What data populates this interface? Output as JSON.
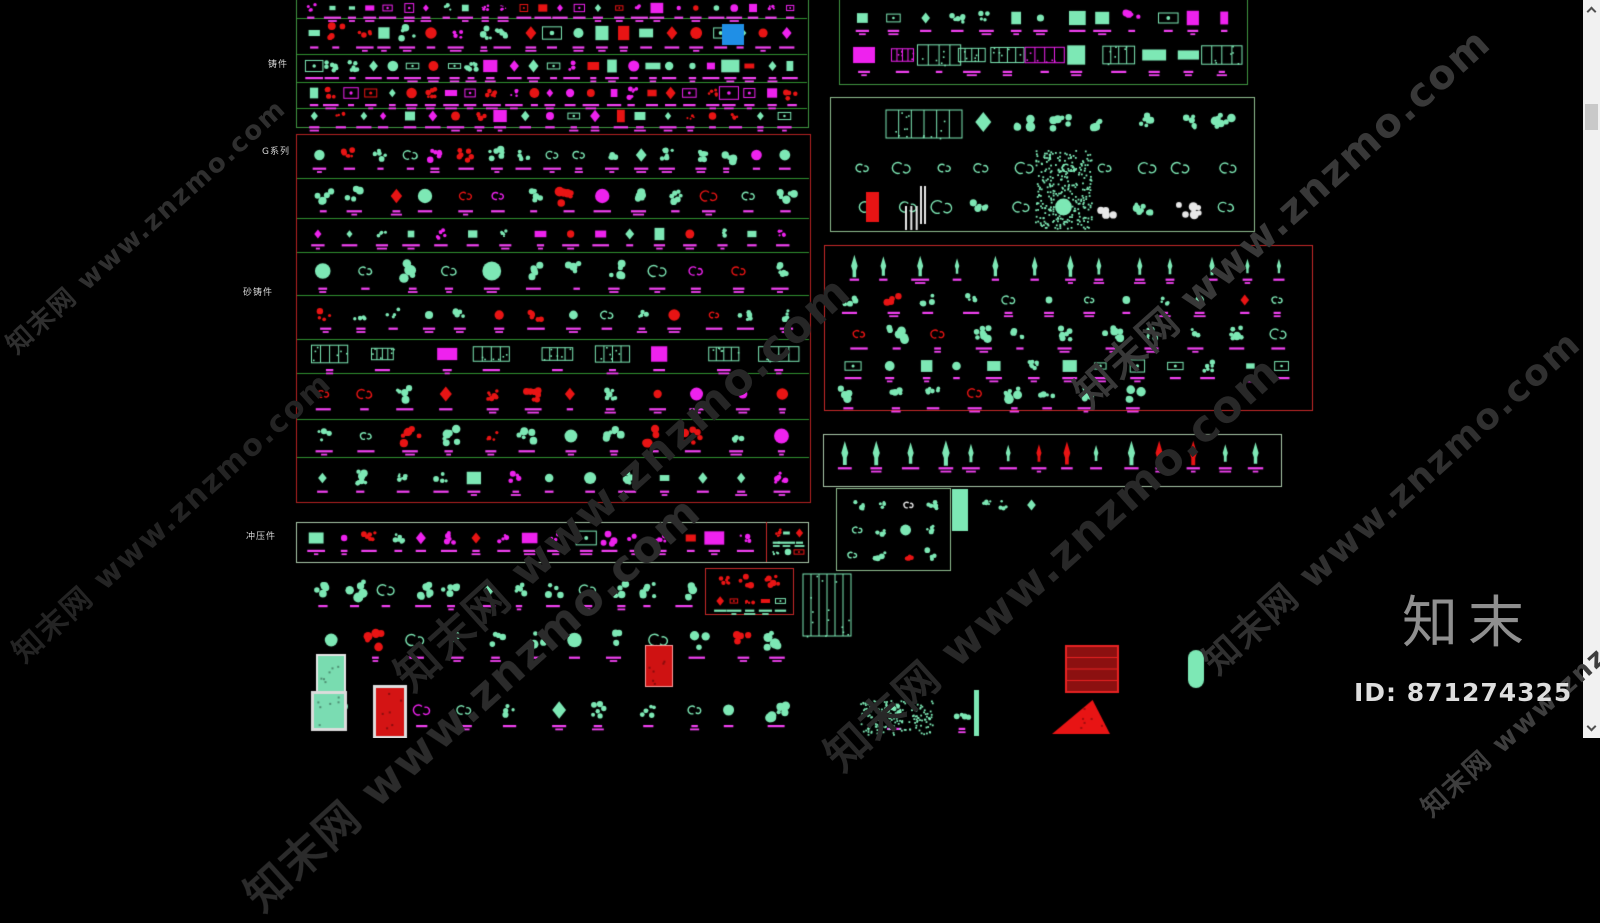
{
  "canvas": {
    "width": 1600,
    "height": 738,
    "bg": "#000000"
  },
  "palette": {
    "teal": "#7de8b5",
    "magenta": "#ee22ee",
    "magenta_label": "#f241f2",
    "red": "#e81414",
    "white": "#e8e8e8",
    "blue": "#1f8fe6",
    "green_line": "#2f8f2f",
    "green_box": "#3f9440",
    "pale_green_box": "#a9c7a9",
    "soft_green_box": "#8fbc8f",
    "red_box": "#c62828",
    "dark_red_box": "#b42222"
  },
  "category_labels": [
    {
      "text": "铸件",
      "x": 268,
      "y": 61
    },
    {
      "text": "G系列",
      "x": 262,
      "y": 148
    },
    {
      "text": "砂铸件",
      "x": 243,
      "y": 289
    },
    {
      "text": "冲压件",
      "x": 246,
      "y": 533
    }
  ],
  "watermark": {
    "text": "知末网 www.znzmo.com",
    "instances": [
      {
        "x": 145,
        "y": 225,
        "size": 26,
        "color": "#2f2f2f"
      },
      {
        "x": 170,
        "y": 515,
        "size": 30,
        "color": "#242424"
      },
      {
        "x": 620,
        "y": 480,
        "size": 44,
        "color": "#262626"
      },
      {
        "x": 470,
        "y": 700,
        "size": 44,
        "color": "#2b2b2b"
      },
      {
        "x": 1050,
        "y": 560,
        "size": 44,
        "color": "#282828"
      },
      {
        "x": 1280,
        "y": 215,
        "size": 40,
        "color": "#383838"
      },
      {
        "x": 1390,
        "y": 500,
        "size": 36,
        "color": "#303030"
      },
      {
        "x": 1560,
        "y": 688,
        "size": 26,
        "color": "#3e3e3e"
      }
    ]
  },
  "brand": {
    "logo_text": "知末",
    "id_text": "ID: 871274325"
  },
  "scrollbar": {
    "thumb_top": 104,
    "thumb_height": 26
  },
  "groups": [
    {
      "name": "cast-parts-group",
      "box": [
        296,
        -6,
        512,
        133
      ],
      "border": "#3f9440",
      "lines": [
        18,
        54,
        82,
        108
      ],
      "rows": [
        {
          "cy": 8,
          "x0": 303,
          "x1": 801,
          "count": 26,
          "size": 7,
          "style": "mixed",
          "colors": {
            "m": 6,
            "t": 2,
            "r": 1
          },
          "label": "m"
        },
        {
          "cy": 33,
          "x0": 303,
          "x1": 801,
          "count": 21,
          "size": 13,
          "style": "mixed",
          "colors": {
            "t": 4,
            "r": 3,
            "m": 3
          },
          "label": "m"
        },
        {
          "cy": 66,
          "x0": 303,
          "x1": 801,
          "count": 25,
          "size": 10,
          "style": "mixed",
          "colors": {
            "t": 5,
            "m": 3,
            "r": 1
          },
          "label": "m"
        },
        {
          "cy": 93,
          "x0": 303,
          "x1": 801,
          "count": 25,
          "size": 10,
          "style": "mixed",
          "colors": {
            "r": 4,
            "m": 4,
            "t": 2
          },
          "label": "m"
        },
        {
          "cy": 116,
          "x0": 303,
          "x1": 795,
          "count": 21,
          "size": 9,
          "style": "mixed",
          "colors": {
            "r": 3,
            "t": 4,
            "m": 2
          },
          "label": "m"
        }
      ]
    },
    {
      "name": "g-series-group",
      "box": [
        296,
        134,
        514,
        368
      ],
      "border": "#b42222",
      "lines": [
        178,
        218,
        252,
        295,
        339,
        373,
        419,
        457
      ],
      "rows": [
        {
          "cy": 155,
          "x0": 305,
          "x1": 800,
          "count": 17,
          "size": 12,
          "style": "ornament",
          "colors": {
            "t": 6,
            "r": 3,
            "m": 1
          },
          "label": "m"
        },
        {
          "cy": 196,
          "x0": 305,
          "x1": 800,
          "count": 14,
          "size": 14,
          "style": "ornament",
          "colors": {
            "t": 6,
            "r": 2,
            "m": 2
          },
          "label": "m"
        },
        {
          "cy": 234,
          "x0": 305,
          "x1": 800,
          "count": 16,
          "size": 9,
          "style": "mixed",
          "colors": {
            "t": 5,
            "m": 4,
            "r": 1
          },
          "label": "m"
        },
        {
          "cy": 271,
          "x0": 305,
          "x1": 800,
          "count": 12,
          "size": 17,
          "style": "ornament",
          "colors": {
            "t": 8,
            "r": 1,
            "m": 1
          },
          "label": "m"
        },
        {
          "cy": 315,
          "x0": 305,
          "x1": 800,
          "count": 14,
          "size": 12,
          "style": "ornament",
          "colors": {
            "t": 6,
            "r": 2,
            "m": 2
          },
          "label": "m"
        },
        {
          "cy": 354,
          "x0": 305,
          "x1": 800,
          "count": 9,
          "size": 15,
          "style": "panel",
          "colors": {
            "t": 9,
            "m": 1
          },
          "label": "m"
        },
        {
          "cy": 394,
          "x0": 305,
          "x1": 800,
          "count": 12,
          "size": 14,
          "style": "ornament",
          "colors": {
            "r": 5,
            "t": 4,
            "m": 1
          },
          "label": "m"
        },
        {
          "cy": 436,
          "x0": 305,
          "x1": 800,
          "count": 12,
          "size": 14,
          "style": "ornament",
          "colors": {
            "r": 3,
            "t": 6,
            "m": 1
          },
          "label": "m"
        },
        {
          "cy": 478,
          "x0": 305,
          "x1": 800,
          "count": 13,
          "size": 12,
          "style": "mixed",
          "colors": {
            "t": 7,
            "m": 2,
            "r": 1
          },
          "label": "m"
        }
      ]
    },
    {
      "name": "stamped-parts-strip",
      "box": [
        296,
        522,
        512,
        40
      ],
      "border": "#a9c7a9",
      "lines": [],
      "rows": [
        {
          "cy": 538,
          "x0": 304,
          "x1": 756,
          "count": 17,
          "size": 11,
          "style": "mixed",
          "colors": {
            "m": 6,
            "r": 3,
            "t": 2
          },
          "label": "m"
        },
        {
          "cy": 533,
          "x0": 770,
          "x1": 804,
          "count": 3,
          "size": 7,
          "style": "mixed",
          "colors": {
            "t": 6,
            "r": 4
          },
          "label": "t"
        },
        {
          "cy": 552,
          "x0": 770,
          "x1": 804,
          "count": 3,
          "size": 6,
          "style": "mixed",
          "colors": {
            "t": 5,
            "r": 5
          },
          "label": ""
        }
      ]
    },
    {
      "name": "red-detail-box",
      "box": [
        705,
        568,
        88,
        46
      ],
      "border": "#c62828",
      "lines": [],
      "rows": [
        {
          "cy": 581,
          "x0": 712,
          "x1": 786,
          "count": 3,
          "size": 11,
          "style": "ornament",
          "colors": {
            "r": 10
          },
          "label": ""
        },
        {
          "cy": 601,
          "x0": 712,
          "x1": 786,
          "count": 5,
          "size": 7,
          "style": "mixed",
          "colors": {
            "r": 6,
            "t": 4
          },
          "label": "t"
        }
      ]
    },
    {
      "name": "top-right-group",
      "box": [
        839,
        -6,
        408,
        90
      ],
      "border": "#3f9440",
      "lines": [],
      "rows": [
        {
          "cy": 18,
          "x0": 848,
          "x1": 1240,
          "count": 13,
          "size": 11,
          "style": "mixed",
          "colors": {
            "t": 6,
            "m": 3,
            "r": 1
          },
          "label": "m"
        },
        {
          "cy": 55,
          "x0": 848,
          "x1": 1240,
          "count": 11,
          "size": 16,
          "style": "panel",
          "colors": {
            "t": 7,
            "m": 3
          },
          "label": "m"
        }
      ]
    },
    {
      "name": "scrollwork-group",
      "box": [
        830,
        97,
        424,
        134
      ],
      "border": "#8fbc8f",
      "lines": [],
      "rows": [
        {
          "cy": 122,
          "x0": 960,
          "x1": 1245,
          "count": 7,
          "size": 16,
          "style": "ornament",
          "colors": {
            "t": 10
          },
          "label": ""
        },
        {
          "cy": 168,
          "x0": 845,
          "x1": 1245,
          "count": 10,
          "size": 15,
          "style": "scroll",
          "colors": {
            "t": 10
          },
          "label": ""
        },
        {
          "cy": 207,
          "x0": 845,
          "x1": 1245,
          "count": 10,
          "size": 17,
          "style": "ornament",
          "colors": {
            "t": 9,
            "w": 1
          },
          "label": ""
        }
      ]
    },
    {
      "name": "finials-red-group",
      "box": [
        824,
        245,
        488,
        165
      ],
      "border": "#c62828",
      "lines": [],
      "rows": [
        {
          "cy": 266,
          "x0": 833,
          "x1": 1300,
          "count": 13,
          "size": 12,
          "style": "finial",
          "colors": {
            "t": 10
          },
          "label": "m"
        },
        {
          "cy": 300,
          "x0": 833,
          "x1": 1300,
          "count": 12,
          "size": 11,
          "style": "ornament",
          "colors": {
            "t": 9,
            "r": 1
          },
          "label": "m"
        },
        {
          "cy": 334,
          "x0": 833,
          "x1": 1300,
          "count": 11,
          "size": 13,
          "style": "ornament",
          "colors": {
            "t": 9,
            "r": 1
          },
          "label": "m"
        },
        {
          "cy": 366,
          "x0": 833,
          "x1": 1300,
          "count": 13,
          "size": 10,
          "style": "mixed",
          "colors": {
            "t": 10
          },
          "label": "m"
        },
        {
          "cy": 393,
          "x0": 833,
          "x1": 1150,
          "count": 8,
          "size": 14,
          "style": "ornament",
          "colors": {
            "t": 9,
            "r": 1
          },
          "label": "m"
        }
      ]
    },
    {
      "name": "spear-tips-strip",
      "box": [
        823,
        434,
        458,
        52
      ],
      "border": "#a9c7a9",
      "lines": [],
      "rows": [
        {
          "cy": 453,
          "x0": 833,
          "x1": 1272,
          "count": 14,
          "size": 14,
          "style": "finial",
          "colors": {
            "t": 11,
            "r": 3
          },
          "label": "m"
        }
      ]
    },
    {
      "name": "misc-small-group",
      "box": [
        836,
        488,
        114,
        82
      ],
      "border": "#8fbc8f",
      "lines": [],
      "rows": [
        {
          "cy": 505,
          "x0": 843,
          "x1": 943,
          "count": 4,
          "size": 11,
          "style": "ornament",
          "colors": {
            "t": 8,
            "w": 2
          },
          "label": ""
        },
        {
          "cy": 530,
          "x0": 843,
          "x1": 943,
          "count": 4,
          "size": 12,
          "style": "ornament",
          "colors": {
            "t": 8,
            "r": 1,
            "w": 1
          },
          "label": ""
        },
        {
          "cy": 555,
          "x0": 843,
          "x1": 943,
          "count": 4,
          "size": 11,
          "style": "ornament",
          "colors": {
            "t": 9,
            "r": 1
          },
          "label": ""
        }
      ]
    }
  ],
  "loose_rows": [
    {
      "cy": 505,
      "x0": 975,
      "x1": 1040,
      "count": 3,
      "size": 10,
      "style": "ornament",
      "colors": {
        "t": 10
      },
      "label": ""
    },
    {
      "cy": 590,
      "x0": 305,
      "x1": 700,
      "count": 12,
      "size": 15,
      "style": "ornament",
      "colors": {
        "t": 9,
        "r": 1
      },
      "label": "m"
    },
    {
      "cy": 640,
      "x0": 310,
      "x1": 800,
      "count": 12,
      "size": 17,
      "style": "ornament",
      "colors": {
        "t": 9,
        "r": 1
      },
      "label": "m"
    },
    {
      "cy": 710,
      "x0": 315,
      "x1": 800,
      "count": 11,
      "size": 15,
      "style": "ornament",
      "colors": {
        "t": 8,
        "r": 1,
        "m": 1
      },
      "label": "m"
    },
    {
      "cy": 712,
      "x0": 855,
      "x1": 1000,
      "count": 2,
      "size": 16,
      "style": "ornament",
      "colors": {
        "t": 10
      },
      "label": "m"
    }
  ],
  "special_items": [
    {
      "kind": "fillrect",
      "x": 722,
      "y": 24,
      "w": 22,
      "h": 21,
      "color": "#1f8fe6"
    },
    {
      "kind": "grille",
      "x": 886,
      "y": 110,
      "w": 76,
      "h": 28,
      "color": "#7de8b5"
    },
    {
      "kind": "speckle",
      "x": 1035,
      "y": 150,
      "w": 56,
      "h": 78,
      "color": "#7de8b5"
    },
    {
      "kind": "fillrect",
      "x": 866,
      "y": 192,
      "w": 13,
      "h": 30,
      "color": "#e81414"
    },
    {
      "kind": "vbars",
      "x": 905,
      "y": 206,
      "w": 16,
      "h": 24,
      "n": 3,
      "color": "#e8e8e8"
    },
    {
      "kind": "vbars",
      "x": 920,
      "y": 186,
      "w": 8,
      "h": 38,
      "n": 2,
      "color": "#e8e8e8"
    },
    {
      "kind": "fillrect",
      "x": 952,
      "y": 489,
      "w": 16,
      "h": 42,
      "color": "#7de8b5"
    },
    {
      "kind": "grille",
      "x": 803,
      "y": 574,
      "w": 48,
      "h": 62,
      "color": "#7de8b5"
    },
    {
      "kind": "framed",
      "x": 318,
      "y": 656,
      "w": 26,
      "h": 38,
      "fill": "#79dcb0",
      "stroke": "#e6e6e6",
      "lw": 2
    },
    {
      "kind": "framed",
      "x": 646,
      "y": 646,
      "w": 26,
      "h": 40,
      "fill": "#cf1212",
      "stroke": "#ff9b9b",
      "lw": 1
    },
    {
      "kind": "grille2",
      "x": 1066,
      "y": 646,
      "w": 52,
      "h": 46,
      "fill": "#8c1010",
      "stroke": "#e82222"
    },
    {
      "kind": "capsule",
      "x": 1188,
      "y": 650,
      "w": 16,
      "h": 38,
      "color": "#7de8b5"
    },
    {
      "kind": "framed",
      "x": 314,
      "y": 694,
      "w": 30,
      "h": 34,
      "fill": "#7adcb2",
      "stroke": "#dcdcdc",
      "lw": 3
    },
    {
      "kind": "framed",
      "x": 376,
      "y": 688,
      "w": 28,
      "h": 48,
      "fill": "#d41414",
      "stroke": "#dedede",
      "lw": 3
    },
    {
      "kind": "fillrect",
      "x": 974,
      "y": 690,
      "w": 5,
      "h": 46,
      "color": "#7de8b5"
    },
    {
      "kind": "tri",
      "x": 1052,
      "y": 700,
      "w": 58,
      "h": 34,
      "color": "#e81414"
    },
    {
      "kind": "speckle",
      "x": 860,
      "y": 700,
      "w": 72,
      "h": 34,
      "color": "#7de8b5"
    },
    {
      "kind": "line",
      "x": 766,
      "y": 522,
      "x2": 766,
      "y2": 562,
      "color": "#c62828"
    }
  ]
}
